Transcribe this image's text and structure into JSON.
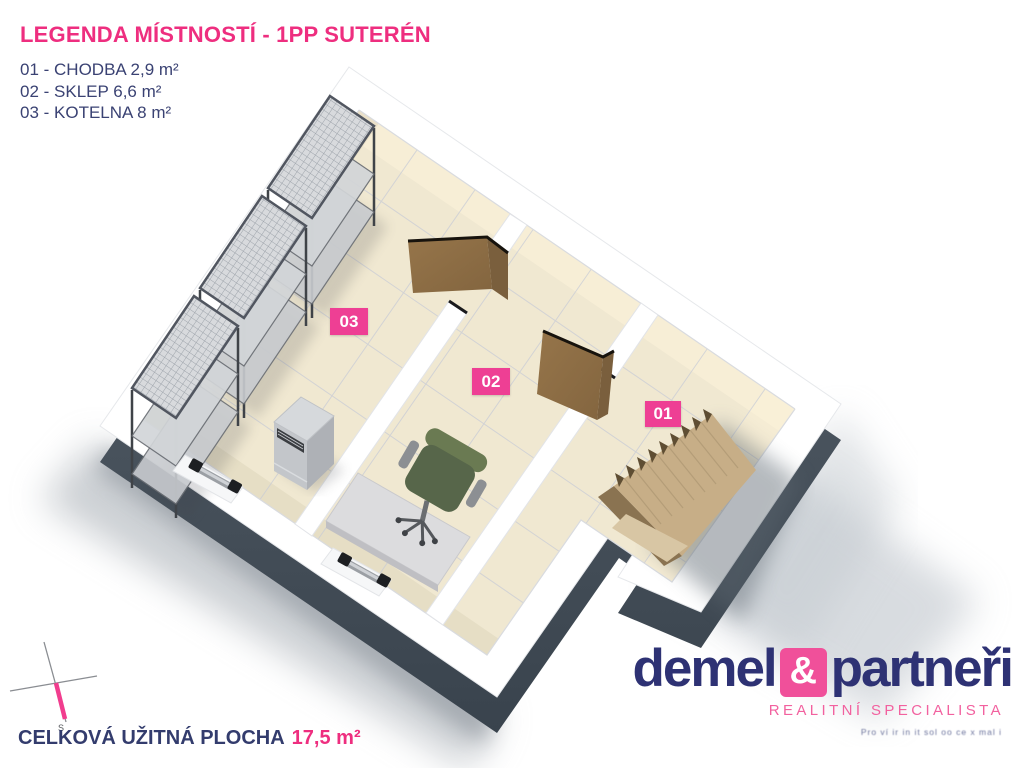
{
  "legend": {
    "title": "LEGENDA MÍSTNOSTÍ - 1PP SUTERÉN",
    "items": [
      {
        "label": "01 - CHODBA 2,9 m²"
      },
      {
        "label": "02 - SKLEP 6,6 m²"
      },
      {
        "label": "03 - KOTELNA 8 m²"
      }
    ]
  },
  "floorplan": {
    "room_labels": [
      {
        "id": "03",
        "name": "KOTELNA"
      },
      {
        "id": "02",
        "name": "SKLEP"
      },
      {
        "id": "01",
        "name": "CHODBA"
      }
    ]
  },
  "total_area": {
    "label": "CELKOVÁ UŽITNÁ PLOCHA",
    "value": "17,5 m²"
  },
  "compass": {
    "south_label": "S"
  },
  "logo": {
    "name_first": "demel",
    "ampersand": "&",
    "name_second": "partneři",
    "subtitle": "REALITNÍ SPECIALISTA",
    "tagline": "Pro ví ir in it sol oo ce x mal i"
  },
  "colors": {
    "accent_pink": "#ee2e7f",
    "badge_pink": "#ee3f94",
    "navy": "#3a4273",
    "logo_navy": "#2e3274",
    "floor_beige": "#f0e8d1",
    "wall_white": "#ffffff",
    "base_slate": "#4b555f",
    "wood_door": "#8d6e46",
    "wood_stair": "#c7ae87"
  }
}
